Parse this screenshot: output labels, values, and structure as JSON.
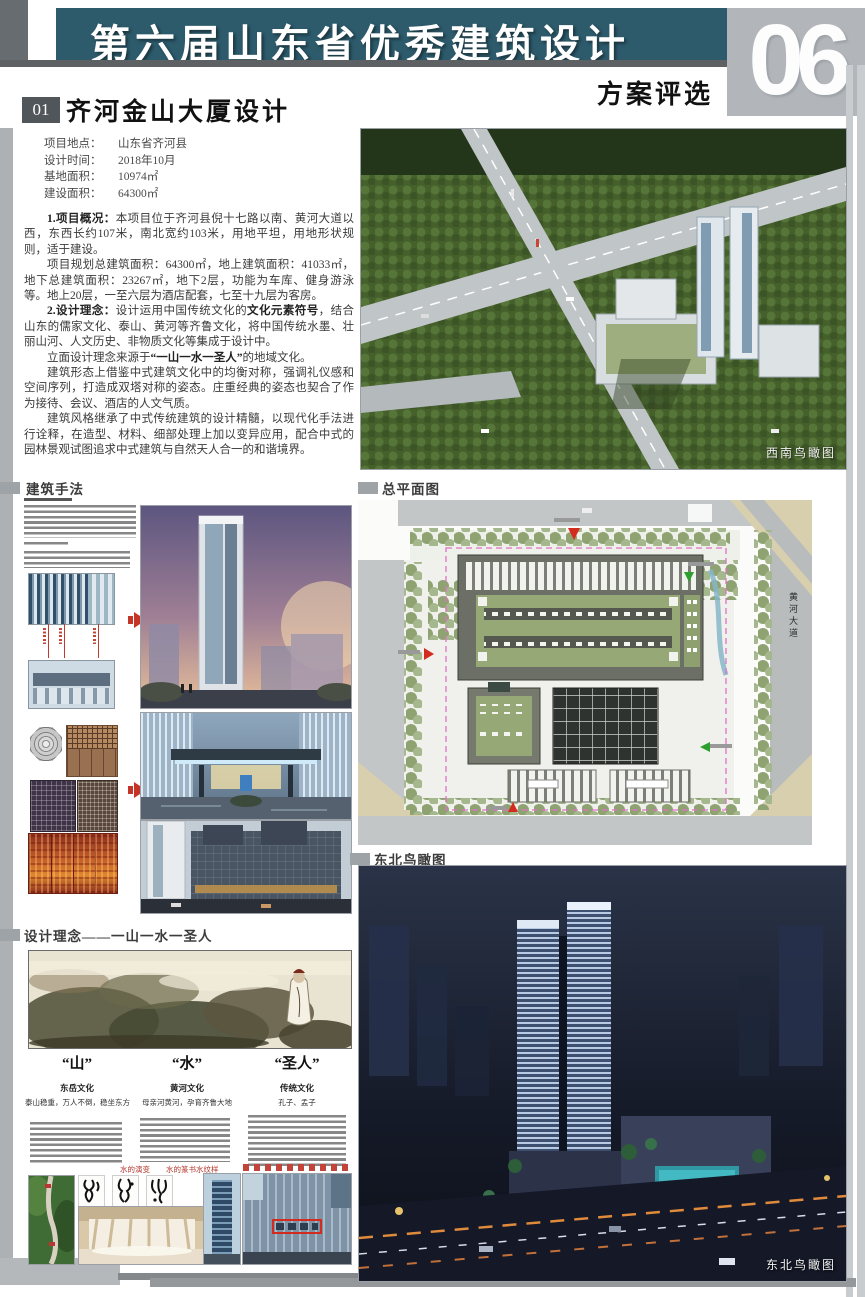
{
  "header": {
    "title": "第六届山东省优秀建筑设计",
    "subtitle": "方案评选",
    "page_number": "06"
  },
  "project": {
    "number": "01",
    "title": "齐河金山大厦设计",
    "info": [
      {
        "label": "项目地点：",
        "value": "山东省齐河县"
      },
      {
        "label": "设计时间：",
        "value": "2018年10月"
      },
      {
        "label": "基地面积：",
        "value": "10974㎡"
      },
      {
        "label": "建设面积：",
        "value": "64300㎡"
      }
    ],
    "body": {
      "p1_head": "1.项目概况：",
      "p1": "本项目位于齐河县倪十七路以南、黄河大道以西，东西长约107米，南北宽约103米，用地平坦，用地形状规则，适于建设。",
      "p2": "项目规划总建筑面积：64300㎡，地上建筑面积：41033㎡，地下总建筑面积：23267㎡，地下2层，功能为车库、健身游泳等。地上20层，一至六层为酒店配套，七至十九层为客房。",
      "p3_head": "2.设计理念：",
      "p3a": "设计运用中国传统文化的",
      "p3b": "文化元素符号",
      "p3c": "，结合山东的儒家文化、泰山、黄河等齐鲁文化，将中国传统水墨、壮丽山河、人文历史、非物质文化等集成于设计中。",
      "p4a": "立面设计理念来源于",
      "p4b": "“一山一水一圣人”",
      "p4c": "的地域文化。",
      "p5": "建筑形态上借鉴中式建筑文化中的均衡对称，强调礼仪感和空间序列，打造成双塔对称的姿态。庄重经典的姿态也契合了作为接待、会议、酒店的人文气质。",
      "p6": "建筑风格继承了中式传统建筑的设计精髓，以现代化手法进行诠释，在造型、材料、细部处理上加以变异应用，配合中式的园林景观试图追求中式建筑与自然天人合一的和谐境界。"
    }
  },
  "sections": {
    "methods": "建筑手法",
    "masterplan": "总平面图",
    "ne_aerial": "东北鸟瞰图",
    "concept": "设计理念——一山一水一圣人"
  },
  "captions": {
    "sw_aerial": "西南鸟瞰图",
    "ne_aerial": "东北鸟瞰图",
    "road_name": "黄河大道"
  },
  "concept_columns": [
    {
      "head": "“山”",
      "sub": "东岳文化",
      "desc": "泰山稳重，万人不倒，稳坐东方"
    },
    {
      "head": "“水”",
      "sub": "黄河文化",
      "desc": "母亲河黄河，孕育齐鲁大地"
    },
    {
      "head": "“圣人”",
      "sub": "传统文化",
      "desc": "孔子、孟子"
    }
  ],
  "red_notes": [
    "水的演变",
    "水的篆书",
    "水纹样"
  ],
  "colors": {
    "accent_teal": "#2d5b6c",
    "badge_gray": "#51565a",
    "red": "#c43527",
    "boundary_pink": "#e070c8"
  }
}
